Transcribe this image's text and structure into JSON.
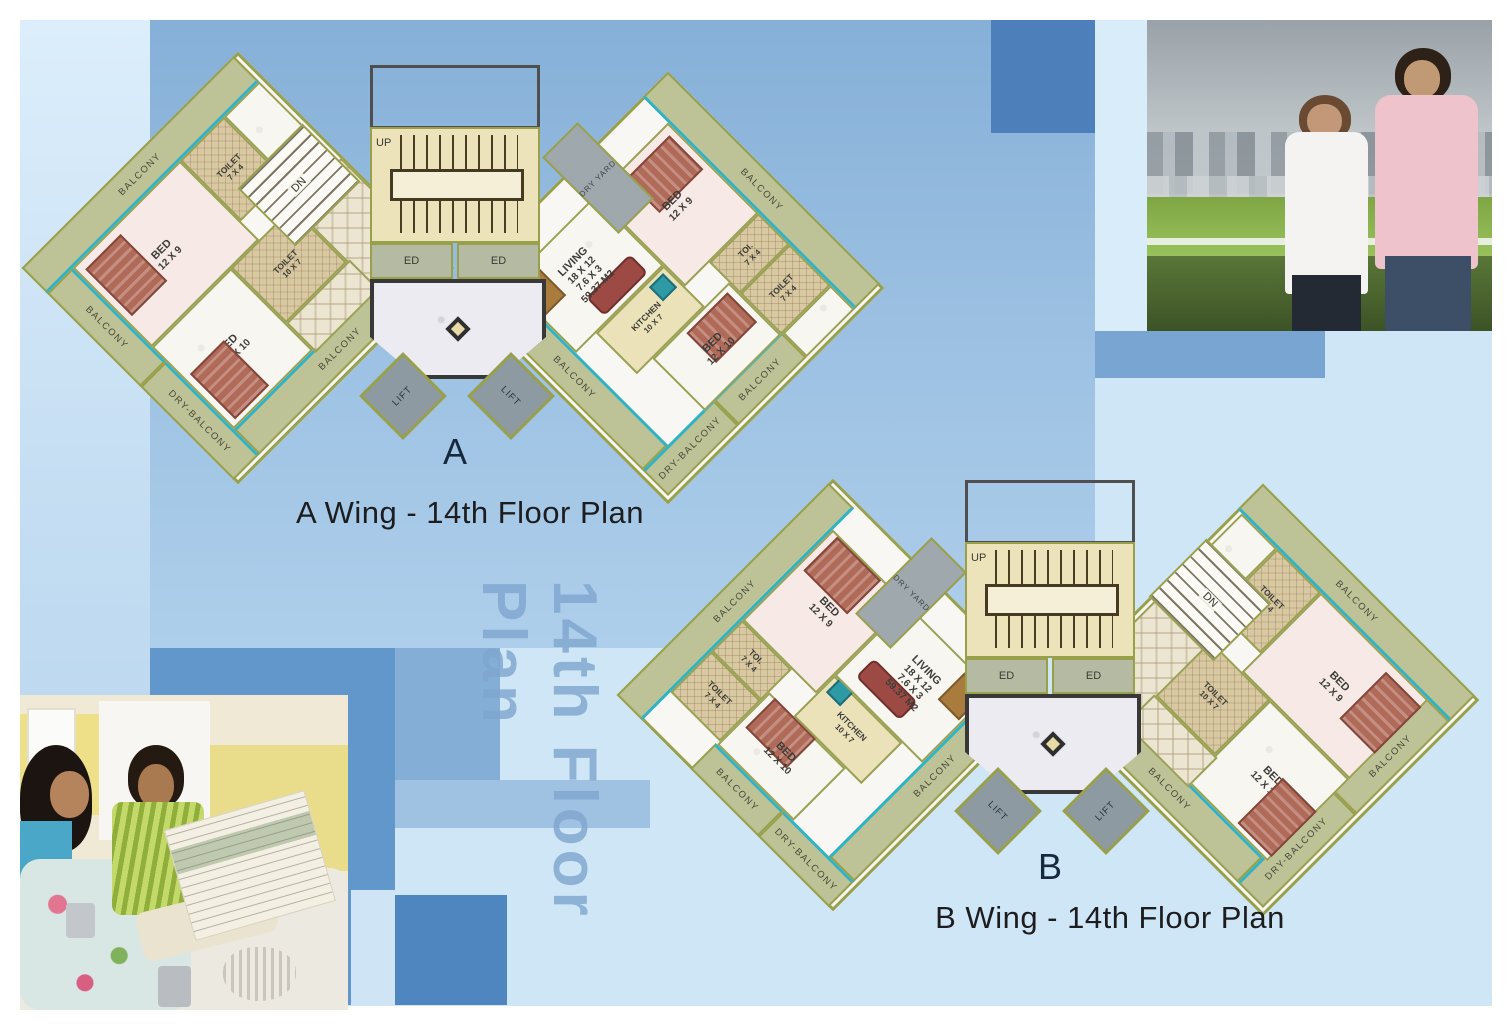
{
  "palette": {
    "bg_light": "#cfe6f7",
    "bg_medium": "#86b0d8",
    "bg_deep": "#6297cc",
    "bg_square_dark": "#4d80bb",
    "wall_olive": "#98a04c",
    "balcony_fill": "#bdc397",
    "teal_edge": "#2fb3c7",
    "toilet_tan": "#d9c9a2",
    "bedroom_pink": "#f6e9e6",
    "stair_yellow": "#ece3bb",
    "lift_grey": "#8d9aa1",
    "watermark_blue": "#7fa6cf"
  },
  "watermark": "14th Floor Plan",
  "wing_a": {
    "caption": "A Wing - 14th Floor Plan",
    "letter": "A",
    "core": {
      "up": "UP",
      "dn": "DN",
      "ed1": "ED",
      "ed2": "ED",
      "lift1": "LIFT",
      "lift2": "LIFT",
      "dry_yard": "DRY YARD"
    },
    "beds_unit": {
      "balcony_top": "BALCONY",
      "balcony_side": "BALCONY",
      "dry_balcony": "DRY-BALCONY",
      "balcony_bottom": "BALCONY",
      "bed1_name": "BED",
      "bed1_size": "12 X 9",
      "toilet1_name": "TOILET",
      "toilet1_size": "7 X 4",
      "bed2_name": "BED",
      "bed2_size": "12 X 10",
      "toilet2_name": "TOILET",
      "toilet2_size": "10 X 7"
    },
    "living_unit": {
      "balcony_top": "BALCONY",
      "balcony_side": "BALCONY",
      "dry_balcony": "DRY-BALCONY",
      "balcony_bottom": "BALCONY",
      "bed1_name": "BED",
      "bed1_size": "12 X 9",
      "toi_name": "TOI.",
      "toi_size": "7 X 4",
      "toilet_name": "TOILET",
      "toilet_size": "7 X 4",
      "bed2_name": "BED",
      "bed2_size": "12 X 10",
      "kitchen_name": "KITCHEN",
      "kitchen_size": "10 X 7",
      "living_name": "LIVING",
      "living_dim": "18 X 12",
      "living_dim2": "7.6 X 3",
      "living_area": "59.37 M2"
    }
  },
  "wing_b": {
    "caption": "B Wing - 14th Floor Plan",
    "letter": "B",
    "core": {
      "up": "UP",
      "dn": "DN",
      "ed1": "ED",
      "ed2": "ED",
      "lift1": "LIFT",
      "lift2": "LIFT",
      "dry_yard": "DRY YARD"
    },
    "beds_unit": {
      "balcony_top": "BALCONY",
      "balcony_side": "BALCONY",
      "dry_balcony": "DRY-BALCONY",
      "balcony_bottom": "BALCONY",
      "bed1_name": "BED",
      "bed1_size": "12 X 9",
      "toilet1_name": "TOILET",
      "toilet1_size": "7 X 4",
      "bed2_name": "BED",
      "bed2_size": "12 X 10",
      "toilet2_name": "TOILET",
      "toilet2_size": "10 X 7"
    },
    "living_unit": {
      "balcony_top": "BALCONY",
      "balcony_side": "BALCONY",
      "dry_balcony": "DRY-BALCONY",
      "balcony_bottom": "BALCONY",
      "bed1_name": "BED",
      "bed1_size": "12 X 9",
      "toi_name": "TOI.",
      "toi_size": "7 X 4",
      "toilet_name": "TOILET",
      "toilet_size": "7 X 4",
      "bed2_name": "BED",
      "bed2_size": "12 X 10",
      "kitchen_name": "KITCHEN",
      "kitchen_size": "10 X 7",
      "living_name": "LIVING",
      "living_dim": "18 X 12",
      "living_dim2": "7.6 X 3",
      "living_area": "59.37 M2"
    }
  }
}
